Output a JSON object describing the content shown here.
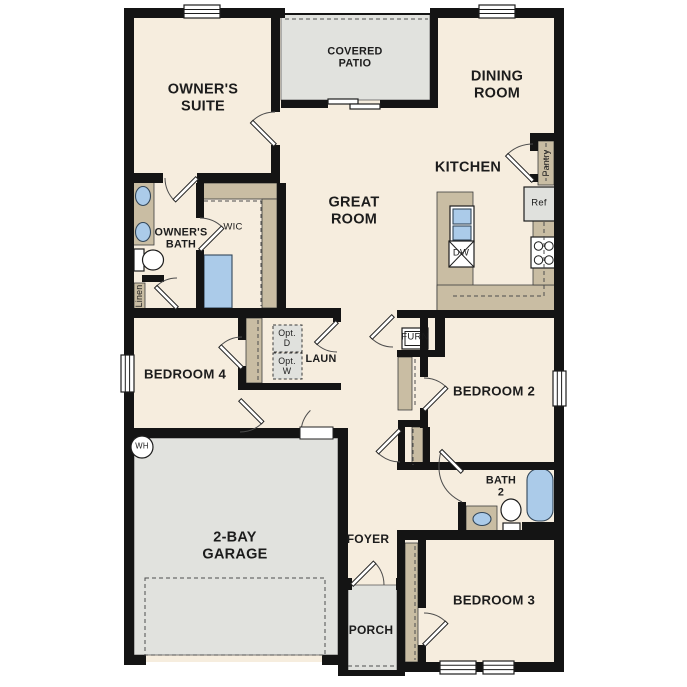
{
  "plan_title": "Single-story 4-bedroom floor plan",
  "colors": {
    "wall": "#141414",
    "floor": "#f6edde",
    "concrete": "#e1e2de",
    "millwork": "#c9bda3",
    "water": "#abcbe9",
    "appliance": "#e0e1dd",
    "ink": "#1c1c1c"
  },
  "labels": {
    "owners_suite": "OWNER'S\nSUITE",
    "covered_patio": "COVERED\nPATIO",
    "dining_room": "DINING\nROOM",
    "great_room": "GREAT\nROOM",
    "kitchen": "KITCHEN",
    "pantry": "Pantry",
    "fridge": "Ref",
    "dishwasher": "DW",
    "owners_bath": "OWNER'S\nBATH",
    "wic": "WIC",
    "linen": "Linen",
    "bedroom4": "BEDROOM 4",
    "laundry": "LAUN",
    "opt_dryer": "Opt.\nD",
    "opt_washer": "Opt.\nW",
    "furnace": "FURN",
    "bedroom2": "BEDROOM 2",
    "water_heater": "WH",
    "garage": "2-BAY\nGARAGE",
    "bath2": "BATH\n2",
    "foyer": "FOYER",
    "porch": "PORCH",
    "bedroom3": "BEDROOM 3"
  }
}
